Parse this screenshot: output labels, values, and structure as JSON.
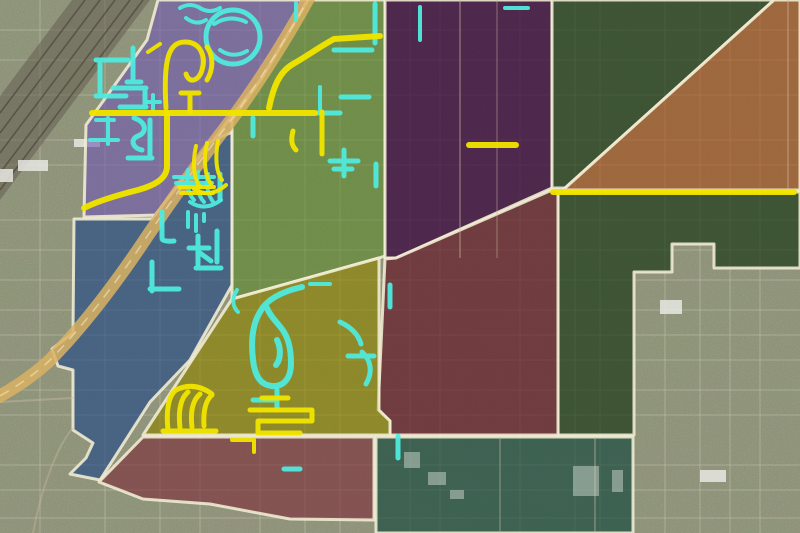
{
  "meta": {
    "width": 800,
    "height": 533,
    "kind": "satellite-district-overlay-map"
  },
  "palette": {
    "base_ground": "#8f8d76",
    "boundary": "#f3eed6",
    "route_yellow": "#f0e400",
    "route_cyan": "#54e8dc",
    "highway_tan": "#d8b266",
    "highway_dash": "#f2e6ba",
    "railroad_band": "#5f584e",
    "railroad_rail": "#3e3a33",
    "grid_road": "#d8d4c0",
    "arterial_light": "#cbb9a0",
    "building_light": "#e8e8e2",
    "building_teal_zone": "#cfd8cd"
  },
  "zones": [
    {
      "id": "purple-northwest",
      "color": "#6e55af",
      "opacity": 0.58,
      "points": "158,0 308,0 262,78 230,118 205,152 178,195 158,215 84,217 86,125 147,40"
    },
    {
      "id": "blue-west",
      "color": "#1e4682",
      "opacity": 0.62,
      "points": "74,219 152,219 190,170 210,142 232,132 232,285 190,360 150,402 100,480 70,474 86,458 93,443 73,430 73,370 58,366 52,349 73,333"
    },
    {
      "id": "green-central",
      "color": "#5a8728",
      "opacity": 0.55,
      "points": "308,0 385,0 385,256 379,258 232,299 232,120 262,78"
    },
    {
      "id": "dark-purple-north",
      "color": "#37063c",
      "opacity": 0.75,
      "points": "385,0 552,0 552,188 396,258 385,258"
    },
    {
      "id": "dark-green-northeast",
      "color": "#193714",
      "opacity": 0.68,
      "points": "552,0 774,0 565,188 552,188"
    },
    {
      "id": "orange-east",
      "color": "#a54b19",
      "opacity": 0.6,
      "points": "774,0 800,0 800,190 563,190"
    },
    {
      "id": "dark-green-east",
      "color": "#193714",
      "opacity": 0.68,
      "points": "558,192 800,192 800,268 714,268 714,244 672,244 672,272 634,272 634,435 558,435"
    },
    {
      "id": "maroon-central",
      "color": "#5f1423",
      "opacity": 0.68,
      "points": "385,259 396,258 552,190 558,190 558,435 390,435 390,421 378,410"
    },
    {
      "id": "olive-south-central",
      "color": "#8c8200",
      "opacity": 0.62,
      "points": "232,299 379,258 379,410 390,421 390,435 143,435"
    },
    {
      "id": "maroon-southwest",
      "color": "#782837",
      "opacity": 0.6,
      "points": "143,437 374,437 374,520 290,519 210,504 143,499 99,482"
    },
    {
      "id": "teal-south",
      "color": "#14463c",
      "opacity": 0.65,
      "points": "376,437 633,437 633,533 376,533"
    }
  ],
  "railroad": {
    "band": "72,0 150,0 0,200 0,96",
    "rails": [
      "M85,0 L0,113",
      "M100,0 L0,133",
      "M115,0 L0,153",
      "M130,0 L0,173",
      "M143,0 L0,190"
    ]
  },
  "highway": {
    "d": "M312,-8 C285,42 250,96 222,132 C196,166 166,208 138,250 C112,288 80,330 48,362 C30,378 10,391 -8,400",
    "width": 13
  },
  "arterials": [
    {
      "d": "M460,0 V258",
      "opacity": 0.35
    },
    {
      "d": "M497,0 V258",
      "opacity": 0.25
    },
    {
      "d": "M788,0 V190",
      "opacity": 0.35
    },
    {
      "d": "M0,402 L73,398",
      "opacity": 0.45
    },
    {
      "d": "M33,533 C42,485 58,445 73,428",
      "opacity": 0.4
    },
    {
      "d": "M500,437 V533",
      "opacity": 0.3
    },
    {
      "d": "M595,437 V533",
      "opacity": 0.35
    }
  ],
  "routes_yellow": [
    {
      "d": "M92,113 H315",
      "w": 6
    },
    {
      "d": "M167,113 V166 C167,180 152,186 138,190 C118,195 98,201 84,208",
      "w": 6
    },
    {
      "d": "M166,108 C163,58 169,42 185,42 C201,42 206,57 202,70 C199,81 189,84 186,74",
      "w": 5
    },
    {
      "d": "M207,47 C214,57 213,70 207,80",
      "w": 5
    },
    {
      "d": "M181,93 H199 M190,93 V112",
      "w": 5
    },
    {
      "d": "M269,108 C273,88 279,72 293,64 C307,56 321,46 334,39 L380,36",
      "w": 6
    },
    {
      "d": "M293,131 C291,139 291,145 296,150",
      "w": 5
    },
    {
      "d": "M322,112 V154",
      "w": 5
    },
    {
      "d": "M469,145 H516",
      "w": 6
    },
    {
      "d": "M553,192 H794",
      "w": 6
    },
    {
      "d": "M179,187 H214 M181,193 H213",
      "w": 4
    },
    {
      "d": "M196,146 C192,164 194,179 200,187 M207,143 C203,161 205,176 211,184 M218,141 C215,157 216,172 222,180 M194,189 Q210,199 226,185",
      "w": 4
    },
    {
      "d": "M168,430 C166,412 168,396 176,390 M180,428 C178,410 181,398 188,392 M192,427 C190,410 193,400 200,394 M204,426 C203,410 206,400 212,395 M163,431 H216 M176,390 Q194,381 212,394",
      "w": 5
    },
    {
      "d": "M250,410 H312 V421 H258 V433 H300 M262,398 H288",
      "w": 5
    },
    {
      "d": "M232,440 H254 M254,440 V452",
      "w": 4
    },
    {
      "d": "M148,52 L160,44",
      "w": 4
    }
  ],
  "routes_cyan": [
    {
      "d": "M233,10 A27,27 0 1,0 233,64 A27,27 0 1,0 233,10",
      "w": 5
    },
    {
      "d": "M214,24 Q230,14 246,22 M220,50 Q233,59 247,51",
      "w": 4
    },
    {
      "d": "M180,8 Q190,2 200,8 Q210,14 220,8 M186,18 Q196,26 206,20",
      "w": 4
    },
    {
      "d": "M96,60 H128 M100,60 V94 M96,96 H126",
      "w": 5
    },
    {
      "d": "M133,48 V82 M127,82 H141",
      "w": 5
    },
    {
      "d": "M113,88 H146 M145,88 V106 M120,107 H146",
      "w": 5
    },
    {
      "d": "M153,95 V110 M147,102 H160",
      "w": 4
    },
    {
      "d": "M134,118 C146,122 148,132 138,136 C130,139 132,148 142,150",
      "w": 5
    },
    {
      "d": "M96,120 H114 M90,140 H118 M108,118 V144",
      "w": 4
    },
    {
      "d": "M150,120 V158 M128,158 H152",
      "w": 5
    },
    {
      "d": "M316,113 H340 M341,97 H369",
      "w": 5
    },
    {
      "d": "M253,118 V136",
      "w": 5
    },
    {
      "d": "M375,4 V43 M334,50 H372",
      "w": 5
    },
    {
      "d": "M420,7 V40 M505,8 H528 M296,3 V20",
      "w": 4
    },
    {
      "d": "M330,161 H358 M334,169 H352 M344,150 V176",
      "w": 5
    },
    {
      "d": "M320,87 V110",
      "w": 4
    },
    {
      "d": "M376,164 V186",
      "w": 5
    },
    {
      "d": "M174,177 H214 M176,183 H212",
      "w": 4
    },
    {
      "d": "M220,174 V199",
      "w": 5
    },
    {
      "d": "M162,212 V238 Q162,242 174,241",
      "w": 5
    },
    {
      "d": "M188,212 V227 M196,215 V231 M204,214 V221",
      "w": 4
    },
    {
      "d": "M198,236 V264 M189,248 H209 M200,253 L211,261",
      "w": 5
    },
    {
      "d": "M217,231 V262",
      "w": 5
    },
    {
      "d": "M196,268 H221 M152,262 V291 M150,289 H179",
      "w": 5
    },
    {
      "d": "M188,170 C186,182 188,194 194,200 M198,172 C196,184 198,196 204,202 M208,174 C206,186 208,196 214,203 M190,202 Q205,212 221,200",
      "w": 4
    },
    {
      "d": "M302,287 C280,292 266,300 260,312 C252,325 251,343 253,360 C255,377 261,385 272,386 C284,387 291,378 291,363 C291,349 288,337 282,329 C276,321 270,316 267,308 M277,340 C281,348 281,359 276,365",
      "w": 6
    },
    {
      "d": "M340,322 Q357,330 361,344 M362,352 C371,360 373,372 366,384 M348,356 H374",
      "w": 5
    },
    {
      "d": "M237,290 C232,298 232,306 238,312 M310,284 H330",
      "w": 4
    },
    {
      "d": "M253,400 H277 M277,390 V408",
      "w": 5
    },
    {
      "d": "M398,436 V458 M284,469 H300",
      "w": 5
    },
    {
      "d": "M390,285 V307",
      "w": 5
    }
  ],
  "grid": {
    "verticals": [
      40,
      105,
      160,
      200,
      260,
      305,
      340,
      410,
      440,
      520,
      575,
      600,
      665,
      700,
      730,
      760
    ],
    "horizontals": [
      30,
      60,
      95,
      140,
      165,
      220,
      250,
      280,
      310,
      335,
      360,
      390,
      415,
      465,
      490,
      518
    ]
  },
  "buildings_ground": [
    {
      "x": 74,
      "y": 139,
      "w": 26,
      "h": 8
    },
    {
      "x": 18,
      "y": 160,
      "w": 30,
      "h": 11
    },
    {
      "x": 0,
      "y": 169,
      "w": 13,
      "h": 13
    },
    {
      "x": 660,
      "y": 300,
      "w": 22,
      "h": 14
    },
    {
      "x": 700,
      "y": 470,
      "w": 26,
      "h": 12
    }
  ],
  "buildings_teal": [
    {
      "x": 404,
      "y": 452,
      "w": 16,
      "h": 16
    },
    {
      "x": 428,
      "y": 472,
      "w": 18,
      "h": 13
    },
    {
      "x": 573,
      "y": 466,
      "w": 26,
      "h": 30
    },
    {
      "x": 612,
      "y": 470,
      "w": 11,
      "h": 22
    },
    {
      "x": 450,
      "y": 490,
      "w": 14,
      "h": 9
    }
  ]
}
